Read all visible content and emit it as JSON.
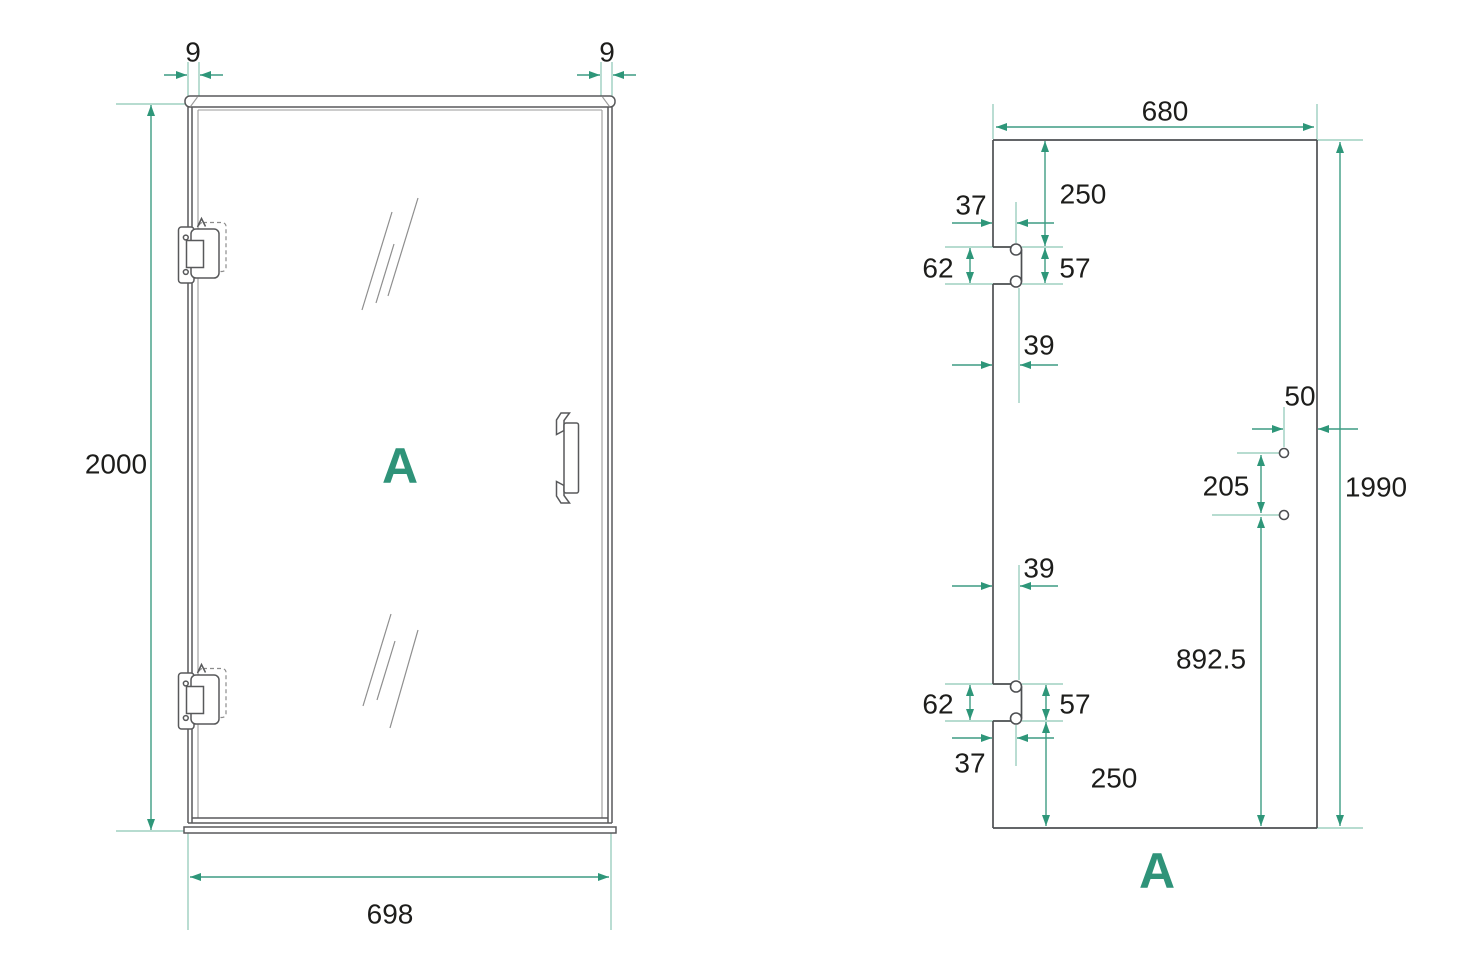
{
  "colors": {
    "dim": "#3d9c83",
    "dim-dark": "#2e9679",
    "ext": "#8cc6b5",
    "line": "#58595b",
    "panel": "#4d4f52",
    "text": "#1d1d1b",
    "accent": "#2f9379"
  },
  "front_view": {
    "view_label": "A",
    "height": "2000",
    "width": "698",
    "frame_offset_left": "9",
    "frame_offset_right": "9"
  },
  "glass_view": {
    "view_label": "A",
    "glass_width": "680",
    "glass_height": "1990",
    "hinge_top_from_top": "250",
    "hinge_top_depth": "37",
    "hinge_top_cutout_height": "62",
    "hinge_top_hole_spacing": "57",
    "hinge_top_center_offset": "39",
    "handle_from_edge": "50",
    "handle_hole_spacing": "205",
    "hinge_bottom_center_offset": "39",
    "handle_from_bottom": "892.5",
    "hinge_bottom_cutout_height": "62",
    "hinge_bottom_hole_spacing": "57",
    "hinge_bottom_depth": "37",
    "hinge_bottom_from_bottom": "250"
  }
}
